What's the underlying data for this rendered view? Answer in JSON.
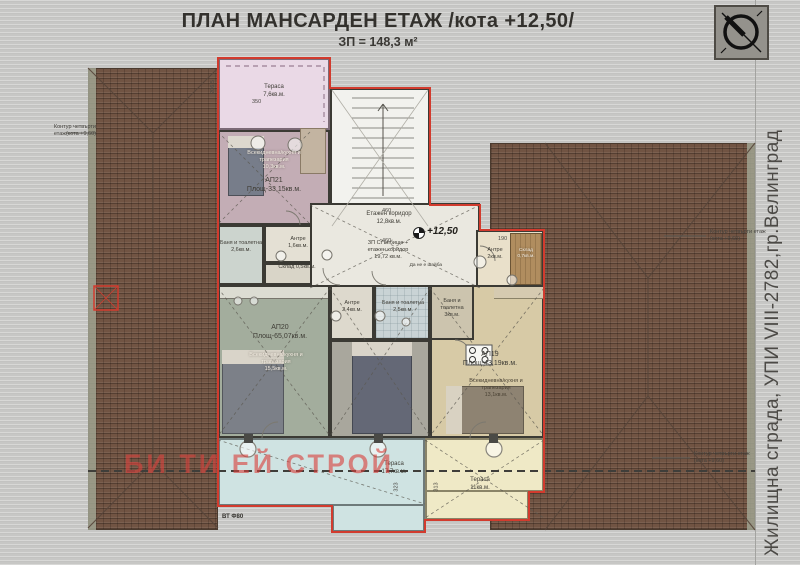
{
  "title": {
    "main": "ПЛАН МАНСАРДЕН ЕТАЖ /кота +12,50/",
    "sub": "ЗП = 148,3 м²"
  },
  "side_label": "Жилищна сграда, УПИ VIII-2782,гр.Велинград",
  "watermark": "БИ ТИ ЕЙ СТРОЙ",
  "bottom_note": "ВТ Ф80",
  "annotations": {
    "left": {
      "l1": "Контур четвърти",
      "l2": "етаж(кота +9,60)"
    },
    "right_top": {
      "l1": "Контур четвърти етаж",
      "l2": "(кота +9,60)"
    },
    "right_bottom": {
      "l1": "Контур четвърти етаж",
      "l2": "(кота +9,60)"
    }
  },
  "plan": {
    "elevation": "+12,50",
    "corridor": {
      "l1": "Етажен коридор",
      "l2": "12,8кв.м."
    },
    "stair_note": {
      "l1": "ЗП Стълбище +",
      "l2": "етажен коридор",
      "l3": "19,72 кв.м."
    },
    "slab_note": "Да не е шайба",
    "rooms": {
      "terrace21": {
        "l1": "Тераса",
        "l2": "7,6кв.м."
      },
      "living21": {
        "l1": "Всекидневна/кухня и",
        "l2": "трапезария",
        "l3": "10,3кв.м."
      },
      "ap21": {
        "id": "АП21",
        "area": "Площ-33,15кв.м."
      },
      "bath21": {
        "l1": "Баня и тоалетна",
        "l2": "2,6кв.м."
      },
      "antre21": {
        "l1": "Антре",
        "l2": "1,6кв.м."
      },
      "storage21": {
        "l1": "Склад",
        "l2": "0,5кв.м."
      },
      "antre19": {
        "l1": "Антре",
        "l2": "2кв.м."
      },
      "storage19": {
        "l1": "Склад",
        "l2": "0,7кв.м."
      },
      "ap20": {
        "id": "АП20",
        "area": "Площ-65,07кв.м."
      },
      "living20": {
        "l1": "Всекидневна/кухня и",
        "l2": "трапезария",
        "l3": "15,5кв.м."
      },
      "antre20": {
        "l1": "Антре",
        "l2": "2,4кв.м."
      },
      "bath20": {
        "l1": "Баня и тоалетна",
        "l2": "2,5кв.м."
      },
      "bath19": {
        "l1": "Баня и тоалетна",
        "l2": "3кв.м."
      },
      "ap19": {
        "id": "АП19",
        "area": "Площ-43,19кв.м."
      },
      "living19": {
        "l1": "Всекидневна/кухня и",
        "l2": "трапезария",
        "l3": "13,1кв.м."
      },
      "terrace_main": {
        "l1": "Тераса",
        "l2": "17,7кв.м."
      },
      "terrace19": {
        "l1": "Тераса",
        "l2": "11кв.м."
      }
    },
    "dims": {
      "terrace_top": "350",
      "side21": "206.5",
      "corr_a": "460",
      "corr_b": "460",
      "entry19": "190",
      "terr_a": "323",
      "terr_b": "313"
    }
  },
  "colors": {
    "plan_outline": "#d23b2e",
    "roof": "#715443",
    "terrace_pink": "#ead9e6",
    "terrace_blue": "#cfe3e2",
    "terrace_cream": "#efe9c6",
    "watermark_red": "#d8423e"
  }
}
